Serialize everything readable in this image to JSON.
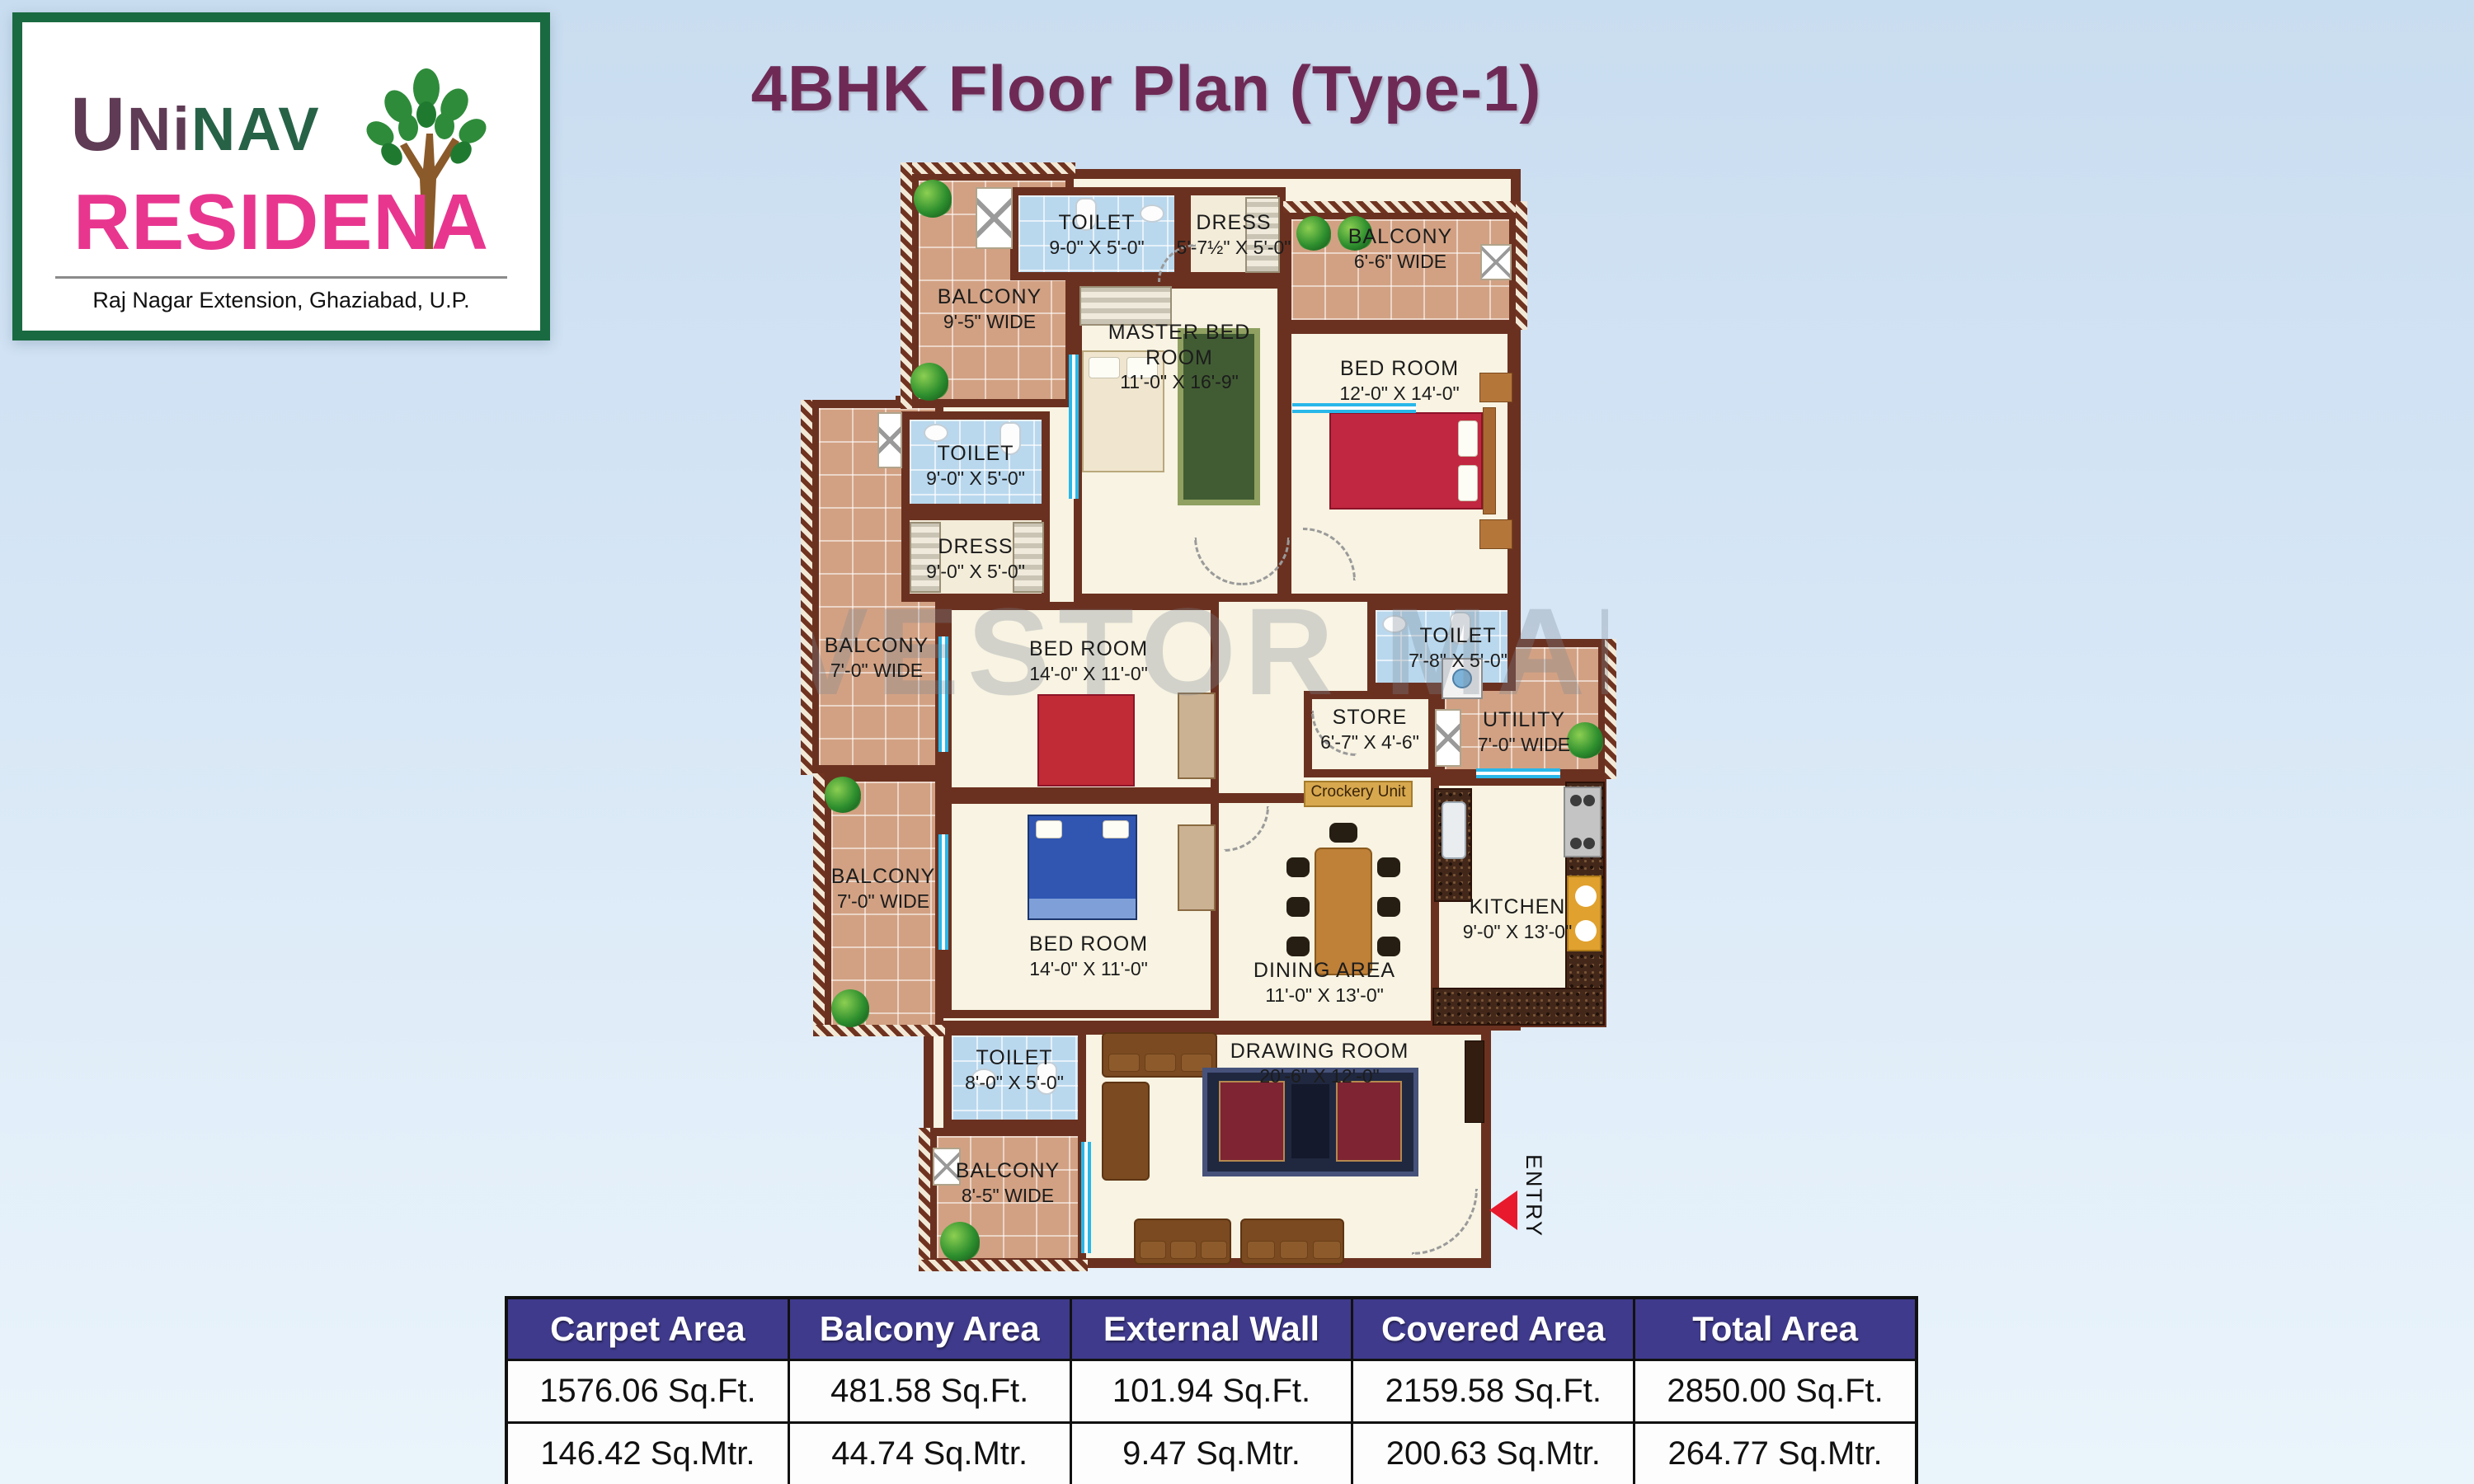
{
  "header": {
    "title": "4BHK Floor Plan (Type-1)"
  },
  "logo": {
    "brand_first_letter": "U",
    "brand_plum_rest": "Ni",
    "brand_green_part": "NAV",
    "brand_line2": "RESIDENA",
    "address": "Raj Nagar Extension, Ghaziabad, U.P."
  },
  "watermark": "INVESTOR MART",
  "floor_plan": {
    "entry_label": "ENTRY",
    "rooms": {
      "balcony_tl": {
        "name": "BALCONY",
        "dims": "9'-5\" WIDE"
      },
      "toilet_top": {
        "name": "TOILET",
        "dims": "9-0\" X 5'-0\""
      },
      "dress_top": {
        "name": "DRESS",
        "dims": "5'-7½\" X 5'-0\""
      },
      "balcony_tr": {
        "name": "BALCONY",
        "dims": "6'-6\" WIDE"
      },
      "master_bedroom": {
        "name": "MASTER BED ROOM",
        "dims": "11'-0\" X 16'-9\""
      },
      "bedroom_right": {
        "name": "BED ROOM",
        "dims": "12'-0\" X 14'-0\""
      },
      "toilet_left": {
        "name": "TOILET",
        "dims": "9'-0\" X 5'-0\""
      },
      "dress_left": {
        "name": "DRESS",
        "dims": "9'-0\" X 5'-0\""
      },
      "balcony_left1": {
        "name": "BALCONY",
        "dims": "7'-0\" WIDE"
      },
      "balcony_left2": {
        "name": "BALCONY",
        "dims": "7'-0\" WIDE"
      },
      "bedroom_mid": {
        "name": "BED ROOM",
        "dims": "14'-0\" X 11'-0\""
      },
      "bedroom_lower": {
        "name": "BED ROOM",
        "dims": "14'-0\" X 11'-0\""
      },
      "toilet_right": {
        "name": "TOILET",
        "dims": "7'-8\" X 5'-0\""
      },
      "store": {
        "name": "STORE",
        "dims": "6'-7\" X 4'-6\""
      },
      "utility": {
        "name": "UTILITY",
        "dims": "7'-0\" WIDE"
      },
      "kitchen": {
        "name": "KITCHEN",
        "dims": "9'-0\" X 13'-0\""
      },
      "dining": {
        "name": "DINING AREA",
        "dims": "11'-0\" X 13'-0\""
      },
      "toilet_bottom": {
        "name": "TOILET",
        "dims": "8'-0\" X 5'-0\""
      },
      "balcony_bottom": {
        "name": "BALCONY",
        "dims": "8'-5\" WIDE"
      },
      "drawing_room": {
        "name": "DRAWING ROOM",
        "dims": "20'-6\" X 12'-0\""
      },
      "crockery_unit": {
        "name": "Crockery Unit"
      }
    }
  },
  "area_table": {
    "headers": [
      "Carpet Area",
      "Balcony Area",
      "External Wall",
      "Covered Area",
      "Total Area"
    ],
    "rows": [
      [
        "1576.06 Sq.Ft.",
        "481.58 Sq.Ft.",
        "101.94 Sq.Ft.",
        "2159.58 Sq.Ft.",
        "2850.00 Sq.Ft."
      ],
      [
        "146.42 Sq.Mtr.",
        "44.74 Sq.Mtr.",
        "9.47 Sq.Mtr.",
        "200.63 Sq.Mtr.",
        "264.77 Sq.Mtr."
      ]
    ]
  },
  "colors": {
    "wall": "#6b3120",
    "title": "#6e2a55",
    "table_header_bg": "#3f3a8c",
    "brand_pink": "#e8368f",
    "brand_green": "#276247",
    "brand_plum": "#5f3b55",
    "window_cyan": "#29b7e9",
    "entry_red": "#e8192c"
  }
}
